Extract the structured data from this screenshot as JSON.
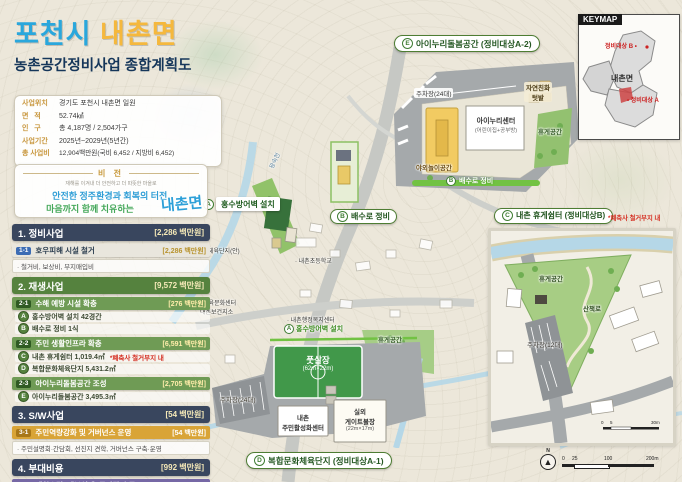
{
  "header": {
    "title1": "포천시",
    "title2": "내촌면",
    "subtitle": "농촌공간정비사업 종합계획도"
  },
  "info": {
    "rows": [
      {
        "label": "사업위치",
        "value": "경기도 포천시 내촌면 일원"
      },
      {
        "label": "면   적",
        "value": "52.74㎢"
      },
      {
        "label": "인   구",
        "value": "총 4,187명 / 2,504가구"
      },
      {
        "label": "사업기간",
        "value": "2025년~2029년(5년간)"
      },
      {
        "label": "총 사업비",
        "value": "12,904백만원(국비 6,452 / 지방비 6,452)"
      }
    ]
  },
  "vision": {
    "title": "비 전",
    "tagline": "재해를 이겨내 더 안전하고 더 따뜻한 마을로",
    "line1": "안전한 정주환경과 회복의 터전,",
    "line2": "마음까지 함께 치유하는",
    "logo": "내촌면"
  },
  "sidebar": {
    "sections": [
      {
        "title": "1. 정비사업",
        "total": "[2,286 백만원]",
        "rows": [
          {
            "badge": "1-1",
            "label": "호우피해 시설 철거",
            "cost": "[2,286 백만원]"
          }
        ],
        "note": "· 철거비, 보상비, 부지매입비"
      },
      {
        "title": "2. 재생사업",
        "total": "[9,572 백만원]",
        "rows": [
          {
            "badge": "2-1",
            "label": "수해 예방 시설 확충",
            "cost": "[276 백만원]",
            "items": [
              {
                "m": "A",
                "text": "홍수방어벽 설치 42경간"
              },
              {
                "m": "B",
                "text": "배수로 정비 1식"
              }
            ]
          },
          {
            "badge": "2-2",
            "label": "주민 생활인프라 확충",
            "cost": "[6,591 백만원]",
            "items": [
              {
                "m": "C",
                "text": "내촌 휴게쉼터 1,019.4㎡",
                "note": "*폐축사 철거부지 내"
              },
              {
                "m": "D",
                "text": "복합문화체육단지 5,431.2㎡"
              }
            ]
          },
          {
            "badge": "2-3",
            "label": "아이누리돌봄공간 조성",
            "cost": "[2,705 백만원]",
            "items": [
              {
                "m": "E",
                "text": "아이누리돌봄공간 3,495.3㎡"
              }
            ]
          }
        ]
      },
      {
        "title": "3. S/W사업",
        "total": "[54 백만원]",
        "rows": [
          {
            "badge": "3-1",
            "label": "주민역량강화 및 거버넌스 운영",
            "cost": "[54 백만원]"
          }
        ],
        "note": "· 주민설명회·간담회, 선진지 견학, 거버넌스 구축·운영"
      },
      {
        "title": "4. 부대비용",
        "total": "[992 백만원]",
        "rows": [
          {
            "badge": "4-1",
            "label": "계획수립, 세부설계, 공사감리 등",
            "cost": "[992 백만원]"
          }
        ]
      }
    ]
  },
  "map": {
    "river": "왕숙천",
    "sports_site": "체육단지(안)",
    "school": "· 내촌초등학교",
    "admin": "· 내촌행정복지센터",
    "edu1": "내촌교육문화센터",
    "edu2": "내촌보건지소",
    "pin_a": {
      "m": "A",
      "label": "홍수방어벽 설치"
    },
    "pin_b": {
      "m": "B",
      "label": "배수로 정비"
    }
  },
  "callout_e": {
    "m": "E",
    "title": "아이누리돌봄공간 (정비대상A-2)",
    "parking": "주차장(24대)",
    "garden1": "자연친화",
    "garden2": "텃밭",
    "center": "아이누리센터",
    "center_sub": "(어린이집+공부방)",
    "play": "야외놀이공간",
    "rest": "휴게공간",
    "drain_m": "B",
    "drain": "배수로 정비"
  },
  "callout_d": {
    "m": "D",
    "title": "복합문화체육단지 (정비대상A-1)",
    "wall_m": "A",
    "wall": "홍수방어벽 설치",
    "futsal": "풋살장",
    "futsal_size": "(62m×22m)",
    "parking": "주차장(24대)",
    "center1": "내촌",
    "center2": "주민활성화센터",
    "gate1": "실외",
    "gate2": "게이트볼장",
    "gate3": "(22m×17m)",
    "rest": "휴게공간"
  },
  "callout_c": {
    "m": "C",
    "title": "내촌 휴게쉼터 (정비대상B)",
    "note": "*폐축사 철거부지 내",
    "rest": "휴게공간",
    "trail": "산책로",
    "parking": "주차장(12대)",
    "scale0": "0",
    "scale1": "5",
    "scale2": "30m"
  },
  "keymap": {
    "title": "KEYMAP",
    "region": "내촌면",
    "label_b": "정비대상 B •",
    "label_a": "• 정비대상 A"
  },
  "compass": {
    "n": "N"
  },
  "scalebar": {
    "t0": "0",
    "t1": "25",
    "t2": "100",
    "t3": "200m"
  },
  "colors": {
    "title_blue": "#2aa7dc",
    "title_yellow": "#f5b83d",
    "navy": "#39465e",
    "green": "#55823e",
    "gold": "#d9a437",
    "purple": "#7668a5",
    "red": "#d42b1e",
    "river": "#b5d7e7",
    "road": "#c6c8c4"
  }
}
